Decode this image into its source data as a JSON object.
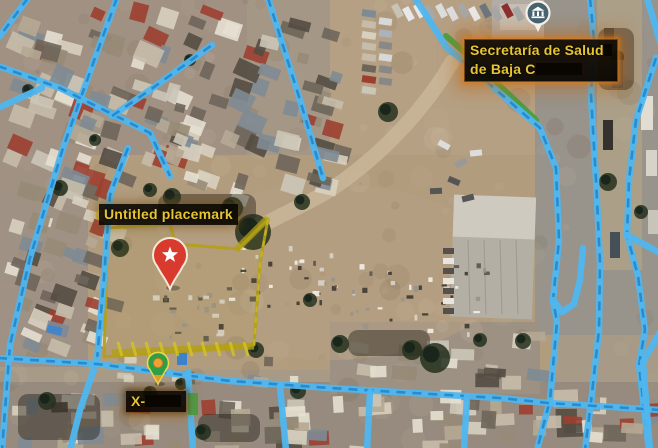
{
  "app": {
    "type": "map-view",
    "mode": "satellite-with-road-overlay"
  },
  "map": {
    "placemark_label": {
      "text": "Untitled placemark"
    },
    "poi_label": {
      "line1": "Secretaría de Salud",
      "line2": "de Baja C",
      "redacted": true
    },
    "street_label": {
      "text": "X-",
      "redacted": true
    },
    "markers": [
      {
        "name": "star-pin",
        "icon": "star",
        "color": "#d93a2e",
        "x": 170,
        "y": 289
      },
      {
        "name": "dot-pin",
        "icon": "dot",
        "color": "#2f9e44",
        "dot_color": "#f0a136",
        "x": 158,
        "y": 384
      },
      {
        "name": "government-poi-pin",
        "icon": "government-building",
        "color": "#47636f",
        "x": 538,
        "y": 28
      }
    ],
    "overlay_colors": {
      "road": "#4fb6ef",
      "road_dash": "#2187cc",
      "route": "#3ba03b",
      "parcel_outline": "#b3a016",
      "label_text": "#e6c432",
      "label_glow": "#c8791c"
    }
  }
}
